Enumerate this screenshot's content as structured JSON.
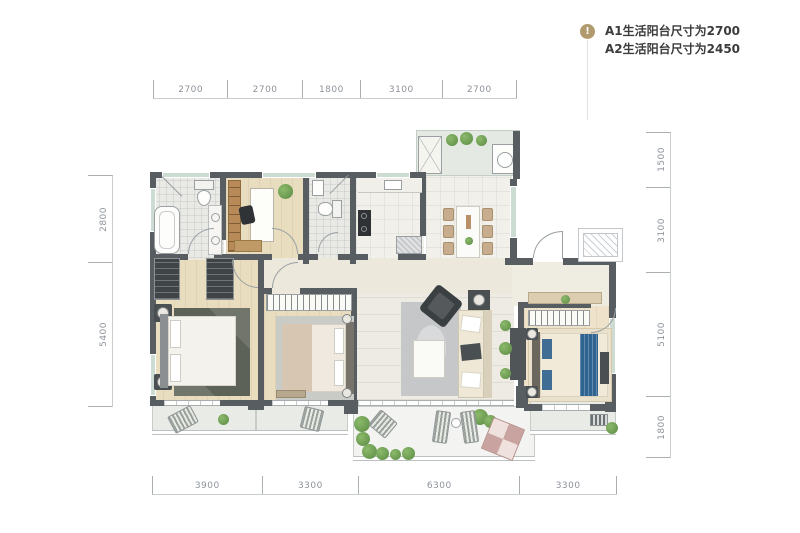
{
  "legend": {
    "icon": "info-icon",
    "icon_glyph": "!",
    "accent_color": "#b29a6f",
    "lines": [
      "A1生活阳台尺寸为2700",
      "A2生活阳台尺寸为2450"
    ]
  },
  "dimensions": {
    "top": [
      "2700",
      "2700",
      "1800",
      "3100",
      "2700"
    ],
    "bottom": [
      "3900",
      "3300",
      "6300",
      "3300"
    ],
    "left": [
      "2800",
      "5400"
    ],
    "right": [
      "1500",
      "3100",
      "5100",
      "1800"
    ]
  },
  "plan": {
    "wall_color": "#585d61",
    "window_color": "#cddcd2",
    "master_bed_accent": "#2f6390",
    "rooms": [
      "bathroom-1",
      "study",
      "bathroom-2",
      "kitchen",
      "foyer-dining",
      "hallway",
      "bedroom-1",
      "bedroom-2",
      "living-room",
      "entry-hall",
      "master-bedroom",
      "life-balcony",
      "balcony-a",
      "balcony-b",
      "garden-balcony",
      "balcony-c"
    ]
  }
}
